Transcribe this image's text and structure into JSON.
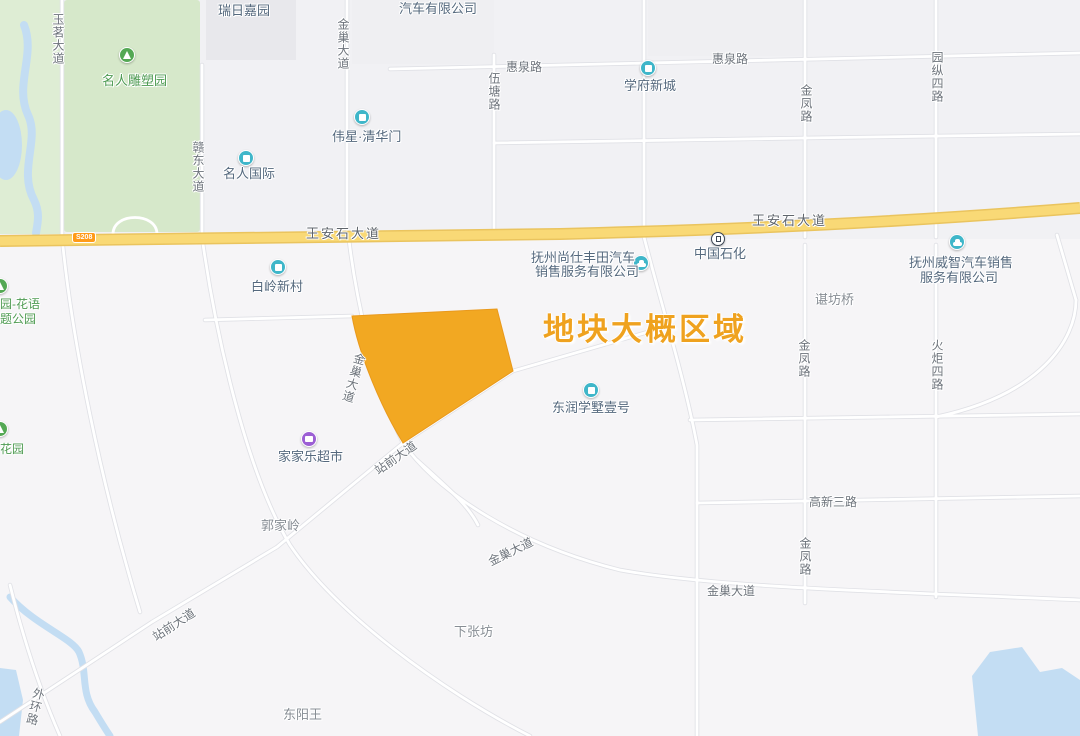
{
  "annotation": {
    "text": "地块大概区域",
    "color": "#EFA21F"
  },
  "plot_polygon": {
    "label": "地块大概区域",
    "fill": "#F2A822"
  },
  "road_labels": {
    "yuming_avenue": "玉茗大道",
    "gandong_avenue": "赣东大道",
    "jinchao_avenue": "金巢大道",
    "wutang_road": "伍塘路",
    "huiquan_road": "惠泉路",
    "jinfeng_road": "金凤路",
    "yuanzong_4th_road": "园纵四路",
    "wanganshi_avenue": "王安石大道",
    "huoju_4th_road": "火炬四路",
    "gaoxin_3rd_road": "高新三路",
    "zhanqian_avenue": "站前大道",
    "waihuan_road": "外环路",
    "s208": "S208"
  },
  "pois": {
    "ruiri_jiayuan": "瑞日嘉园",
    "car_company_partial": "汽车有限公司",
    "mingren_sculpture_park": "名人雕塑园",
    "mingren_international": "名人国际",
    "weixing_qinghuamen": "伟星·清华门",
    "xuefu_xincheng": "学府新城",
    "bailing_xincun": "白岭新村",
    "fuzhou_toyota_line1": "抚州尚仕丰田汽车",
    "fuzhou_toyota_line2": "销售服务有限公司",
    "sinopec": "中国石化",
    "fuzhou_weizhi_line1": "抚州威智汽车销售",
    "fuzhou_weizhi_line2": "服务有限公司",
    "chenfang_bridge": "谌坊桥",
    "dongrun_xueshu": "东润学墅壹号",
    "huayu_park_partial_line1": "园-花语",
    "huayu_park_partial_line2": "题公园",
    "huayuan": "花园",
    "jiajiale_supermarket": "家家乐超市",
    "guojialing": "郭家岭",
    "xiazhangfang": "下张坊",
    "dongyangwang": "东阳王"
  },
  "colors": {
    "plot_polygon": "#F2A822",
    "annotation_text": "#EFA21F",
    "major_road_fill": "#F9D976",
    "major_road_casing": "#EAC45E",
    "s208_badge": "#FF9B19",
    "park_green": "#D6E8CA",
    "water_blue": "#C3DDF3",
    "poi_icon_teal": "#3FB6C9",
    "poi_icon_purple": "#9C5FD4",
    "poi_icon_green": "#54A854"
  }
}
